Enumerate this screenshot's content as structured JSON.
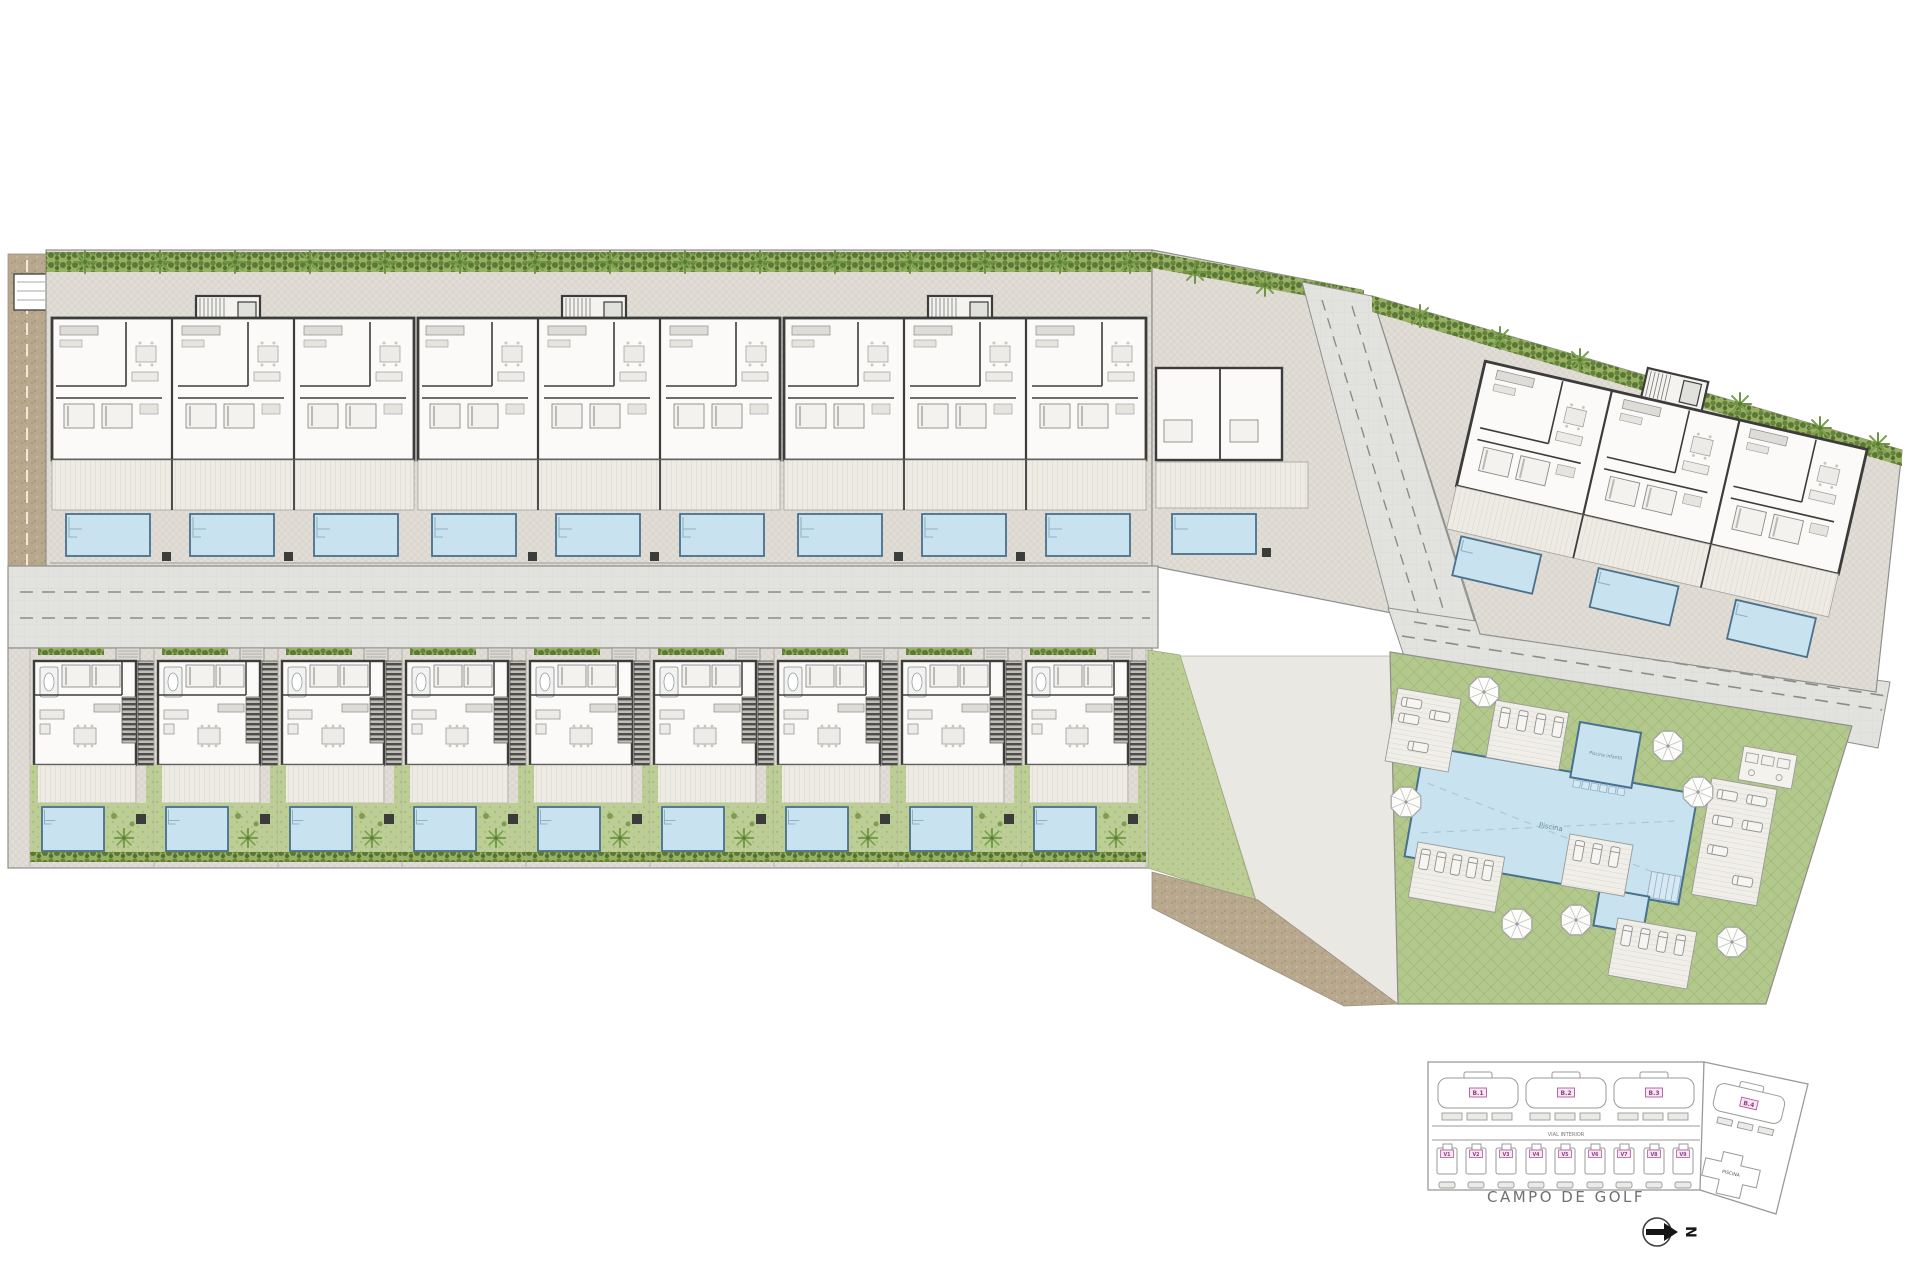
{
  "site": {
    "main_plan": {
      "pool_main_label": "Piscina",
      "pool_kids_label": "Piscina infantil"
    },
    "key_plan": {
      "buildings": [
        "B.1",
        "B.2",
        "B.3",
        "B.4"
      ],
      "villas": [
        "V1",
        "V2",
        "V3",
        "V4",
        "V5",
        "V6",
        "V7",
        "V8",
        "V9"
      ],
      "road_label": "VIAL INTERIOR",
      "pool_label": "PISCINA",
      "golf_label": "CAMPO DE GOLF",
      "north_label": "N"
    },
    "colors": {
      "pool": "#c9e2f0",
      "pool_edge": "#49708c",
      "lawn": "#b3c88d",
      "hedge": "#5a7836",
      "paving": "#e1ded7",
      "road": "#e2e2df",
      "wall": "#3c3c3b",
      "path_tan": "#b8a88d",
      "label_pink": "#b45a9d"
    }
  }
}
